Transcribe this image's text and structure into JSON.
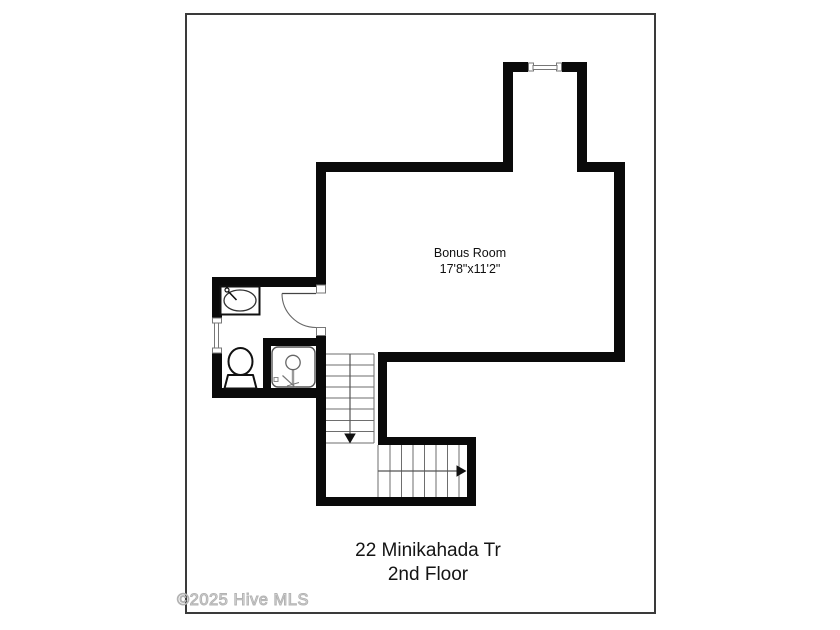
{
  "plan": {
    "room_label": "Bonus Room",
    "room_dimensions": "17'8\"x11'2\"",
    "address_line1": "22 Minikahada Tr",
    "address_line2": "2nd Floor",
    "watermark": "©2025 Hive MLS",
    "colors": {
      "wall": "#0a0a0a",
      "page_border": "#3a3a3a",
      "stair_tread_line": "#6e6e6e",
      "stair_direction_line": "#555555",
      "fixture_outline": "#333333",
      "watermark_gray": "#b3b3b3"
    },
    "icons": {
      "sink": "sink-icon",
      "toilet": "toilet-icon",
      "shower": "shower-icon",
      "door_swing": "door-swing-icon",
      "dormer_window": "window-icon",
      "bathroom_window": "window-icon",
      "stairs_down_arrow": "arrow-down-icon",
      "stairs_right_arrow": "arrow-right-icon"
    }
  }
}
